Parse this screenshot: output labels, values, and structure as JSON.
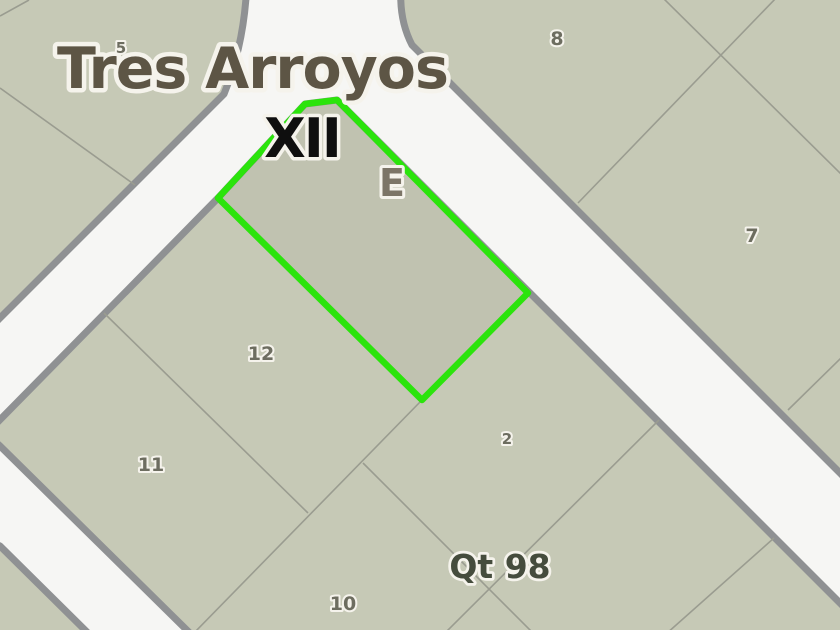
{
  "map": {
    "labels": {
      "city": "Tres Arroyos",
      "block_roman": "XII",
      "highlight_letter": "E",
      "quinta": "Qt 98"
    },
    "parcel_numbers": {
      "p5": "5",
      "p8": "8",
      "p7": "7",
      "p12": "12",
      "p11": "11",
      "p2": "2",
      "p10": "10"
    },
    "highlighted_parcel": {
      "letter": "E",
      "block": "XII",
      "quinta": "Qt 98",
      "outline_color": "#2be40c"
    },
    "colors": {
      "parcel_fill": "#c6c9b6",
      "road_fill": "#f6f6f4",
      "block_border": "#8f9193",
      "thin_parcel_line": "#9a9c90",
      "highlight_green": "#2be40c",
      "city_text": "#5d5545",
      "roman_text": "#0f0f0f",
      "letter_text": "#7c7567",
      "quinta_text": "#454c3d",
      "number_text": "#6d6d60",
      "text_halo": "#f5f3ec"
    }
  }
}
